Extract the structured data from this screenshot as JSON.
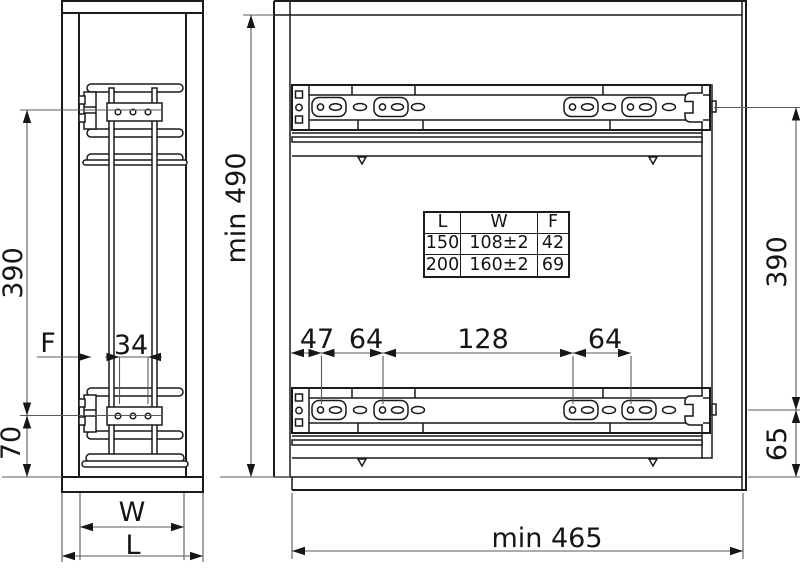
{
  "colors": {
    "line": "#1a1a1a",
    "background": "#ffffff"
  },
  "front_view": {
    "dims": {
      "v390": "390",
      "v70": "70",
      "f": "F",
      "d34": "34",
      "w": "W",
      "l": "L"
    }
  },
  "side_view": {
    "dims": {
      "min_height": "min 490",
      "v390": "390",
      "v65": "65",
      "min_depth": "min 465",
      "d47": "47",
      "d64a": "64",
      "d128": "128",
      "d64b": "64"
    }
  },
  "spec_table": {
    "headers": [
      "L",
      "W",
      "F"
    ],
    "rows": [
      [
        "150",
        "108±2",
        "42"
      ],
      [
        "200",
        "160±2",
        "69"
      ]
    ]
  }
}
